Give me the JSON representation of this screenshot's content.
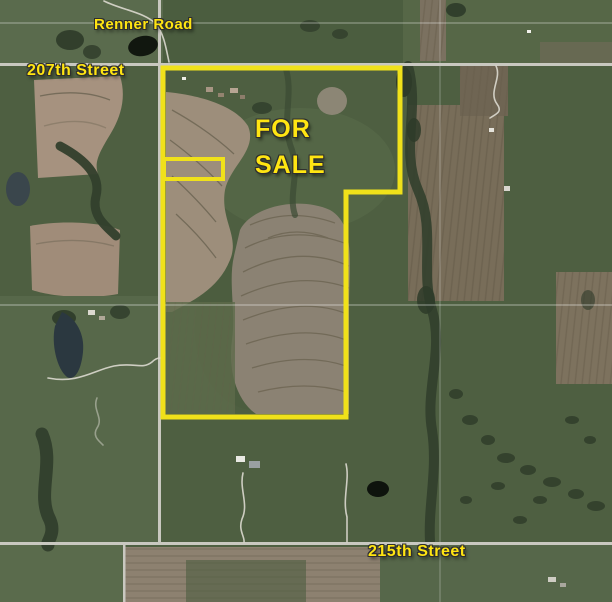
{
  "map": {
    "description": "Aerial satellite plat map showing farmland parcel outlined for sale",
    "road_labels": {
      "renner_road": "Renner Road",
      "street_207": "207th Street",
      "street_215": "215th Street"
    },
    "listing_label": {
      "line1": "FOR",
      "line2": "SALE"
    },
    "colors": {
      "label_text": "#FFE512",
      "label_outline": "#2E2E2E",
      "boundary_yellow": "#F0E11A",
      "road_gray": "#C9C8C0"
    }
  }
}
